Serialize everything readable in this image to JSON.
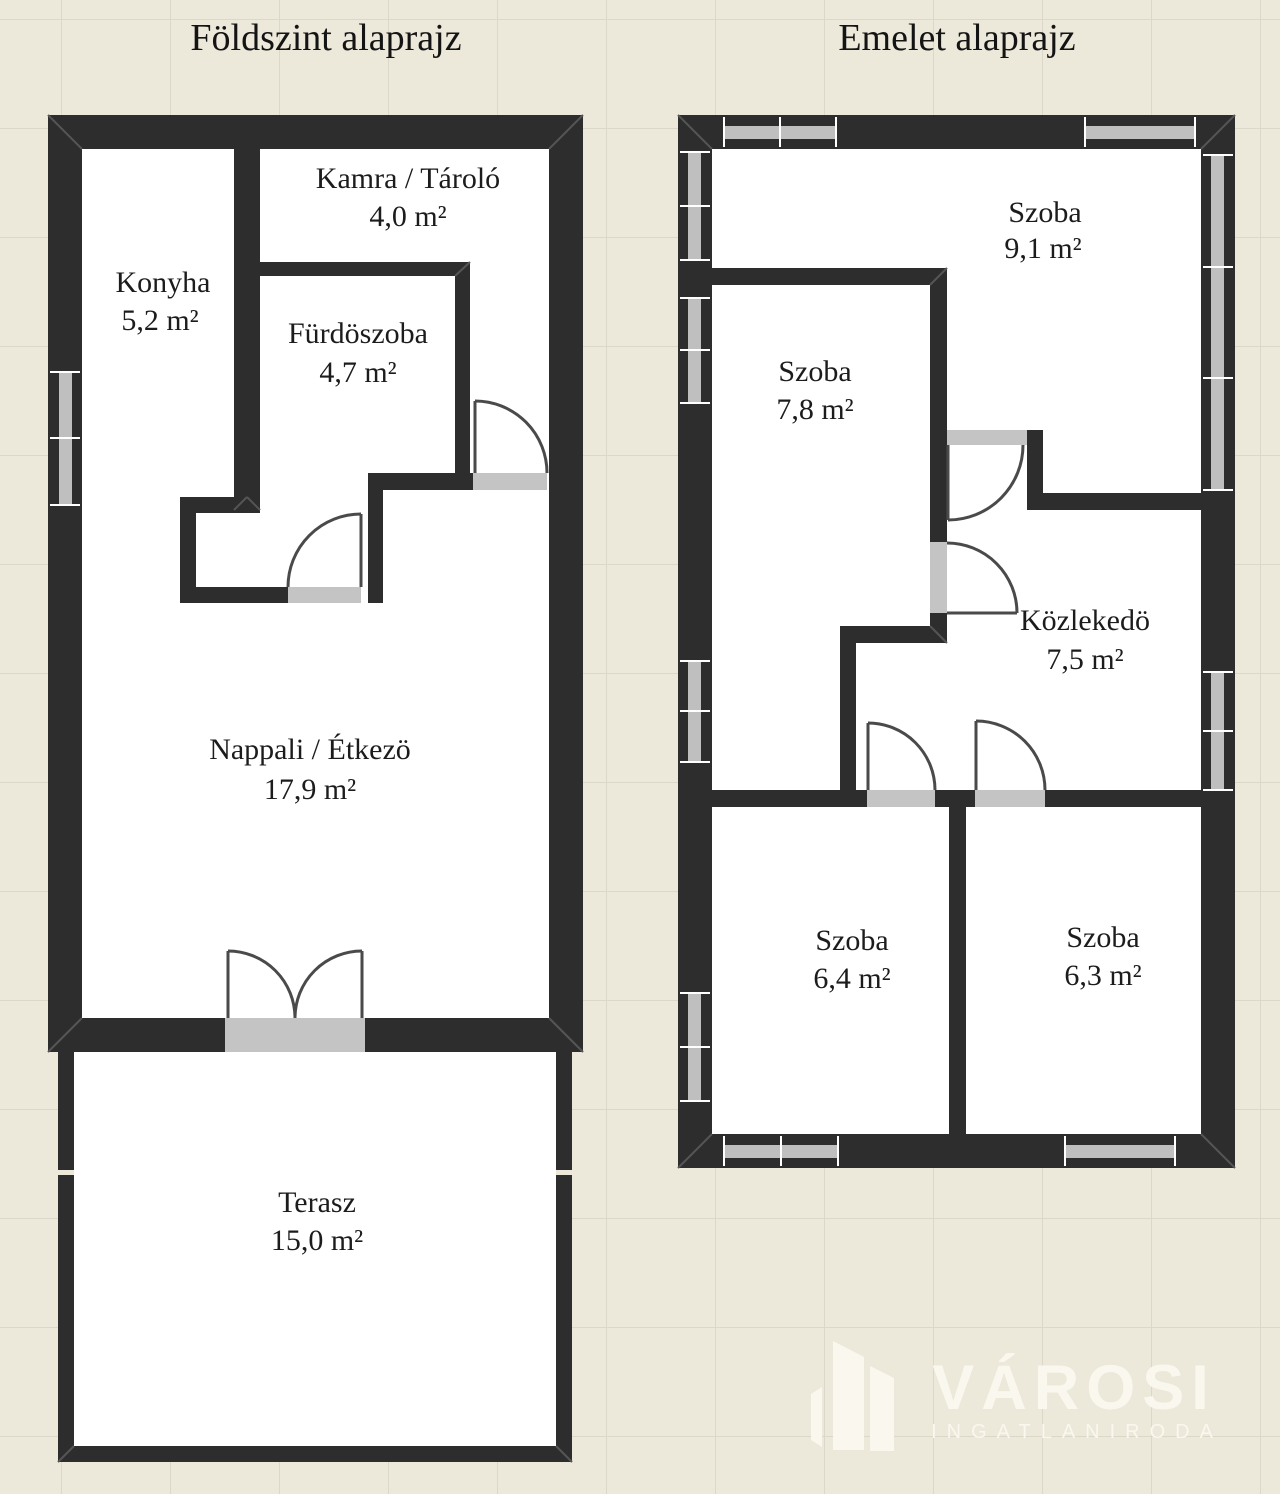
{
  "page": {
    "background_color": "#ece8da",
    "grid_line_color": "#dcd8c9",
    "wall_color": "#2d2d2d",
    "opening_color": "#c4c4c4",
    "text_color": "#1c1c1c"
  },
  "floor_plans": [
    {
      "id": "ground-floor",
      "title": "Földszint alaprajz",
      "rooms": [
        {
          "name": "Konyha",
          "area": "5,2 m²"
        },
        {
          "name": "Kamra / Tároló",
          "area": "4,0 m²"
        },
        {
          "name": "Fürdöszoba",
          "area": "4,7 m²"
        },
        {
          "name": "Nappali / Étkezö",
          "area": "17,9 m²"
        },
        {
          "name": "Terasz",
          "area": "15,0 m²"
        }
      ]
    },
    {
      "id": "upper-floor",
      "title": "Emelet alaprajz",
      "rooms": [
        {
          "name": "Szoba",
          "area": "9,1 m²"
        },
        {
          "name": "Szoba",
          "area": "7,8 m²"
        },
        {
          "name": "Közlekedö",
          "area": "7,5 m²"
        },
        {
          "name": "Szoba",
          "area": "6,4 m²"
        },
        {
          "name": "Szoba",
          "area": "6,3 m²"
        }
      ]
    }
  ],
  "logo": {
    "brand": "VÁROSI",
    "subtitle": "INGATLANIRODA",
    "color": "#faf8ee"
  }
}
